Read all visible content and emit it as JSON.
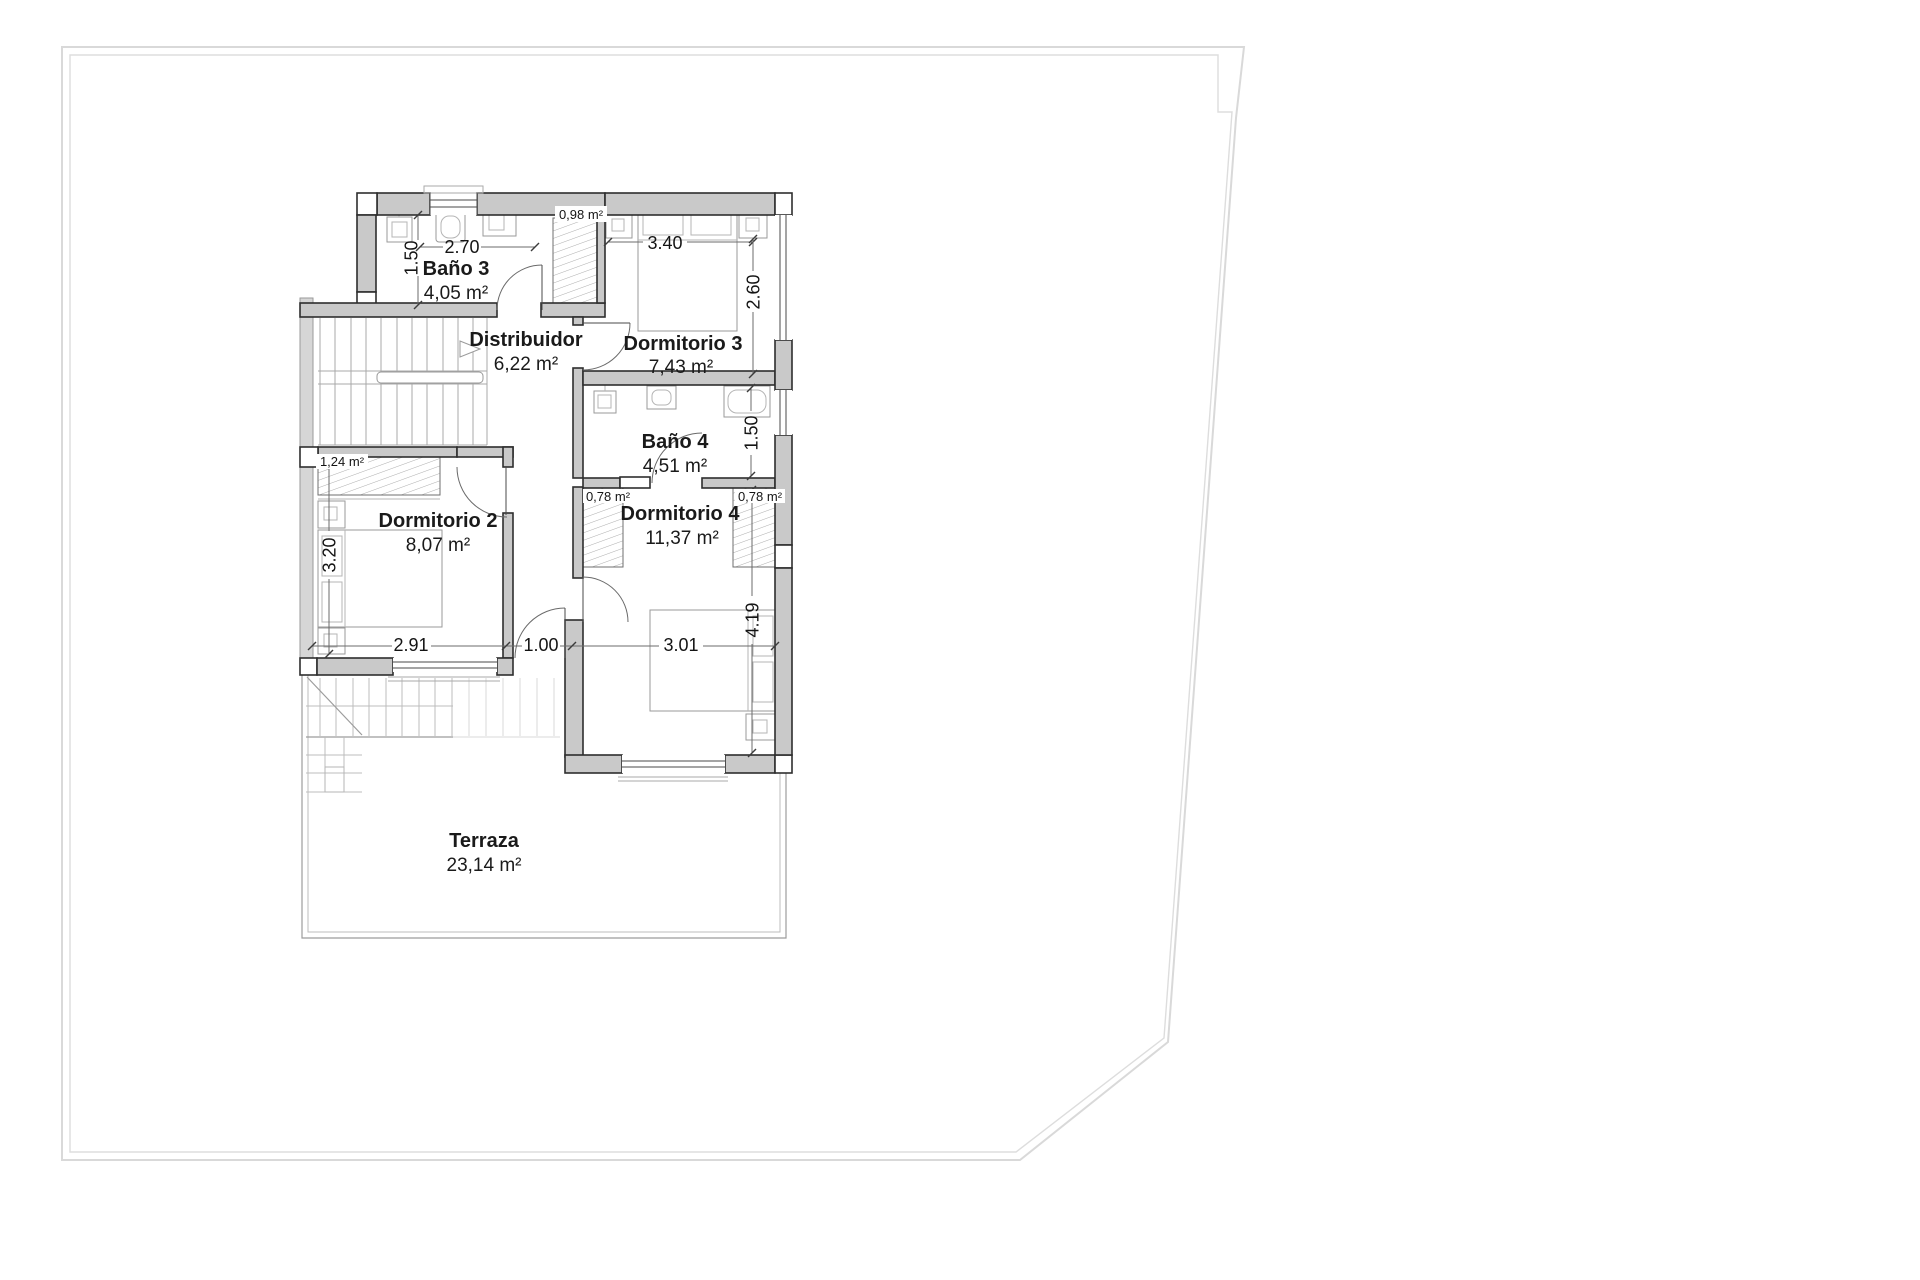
{
  "rooms": [
    {
      "id": "bano3",
      "label": "Baño 3",
      "area": "4,05 m²"
    },
    {
      "id": "distribuidor",
      "label": "Distribuidor",
      "area": "6,22 m²"
    },
    {
      "id": "dormitorio3",
      "label": "Dormitorio 3",
      "area": "7,43 m²"
    },
    {
      "id": "bano4",
      "label": "Baño 4",
      "area": "4,51 m²"
    },
    {
      "id": "dormitorio2",
      "label": "Dormitorio 2",
      "area": "8,07 m²"
    },
    {
      "id": "dormitorio4",
      "label": "Dormitorio 4",
      "area": "11,37 m²"
    },
    {
      "id": "terraza",
      "label": "Terraza",
      "area": "23,14 m²"
    }
  ],
  "closets": [
    {
      "id": "closet-top",
      "area": "0,98 m²"
    },
    {
      "id": "closet-dorm2",
      "area": "1,24 m²"
    },
    {
      "id": "closet-dorm4-left",
      "area": "0,78 m²"
    },
    {
      "id": "closet-dorm4-right",
      "area": "0,78 m²"
    }
  ],
  "dimensions": {
    "bano3_width": "2.70",
    "bano3_depth": "1.50",
    "dorm3_width": "3.40",
    "dorm3_depth": "2.60",
    "bano4_depth": "1.50",
    "dorm2_width": "2.91",
    "dorm2_depth": "3.20",
    "passage_width": "1.00",
    "dorm4_width": "3.01",
    "dorm4_depth": "4.19"
  },
  "colors": {
    "wall_fill": "#c9c9c9",
    "wall_stroke": "#2e2e2e",
    "boundary": "#d9d9d9",
    "text": "#1a1a1a"
  }
}
